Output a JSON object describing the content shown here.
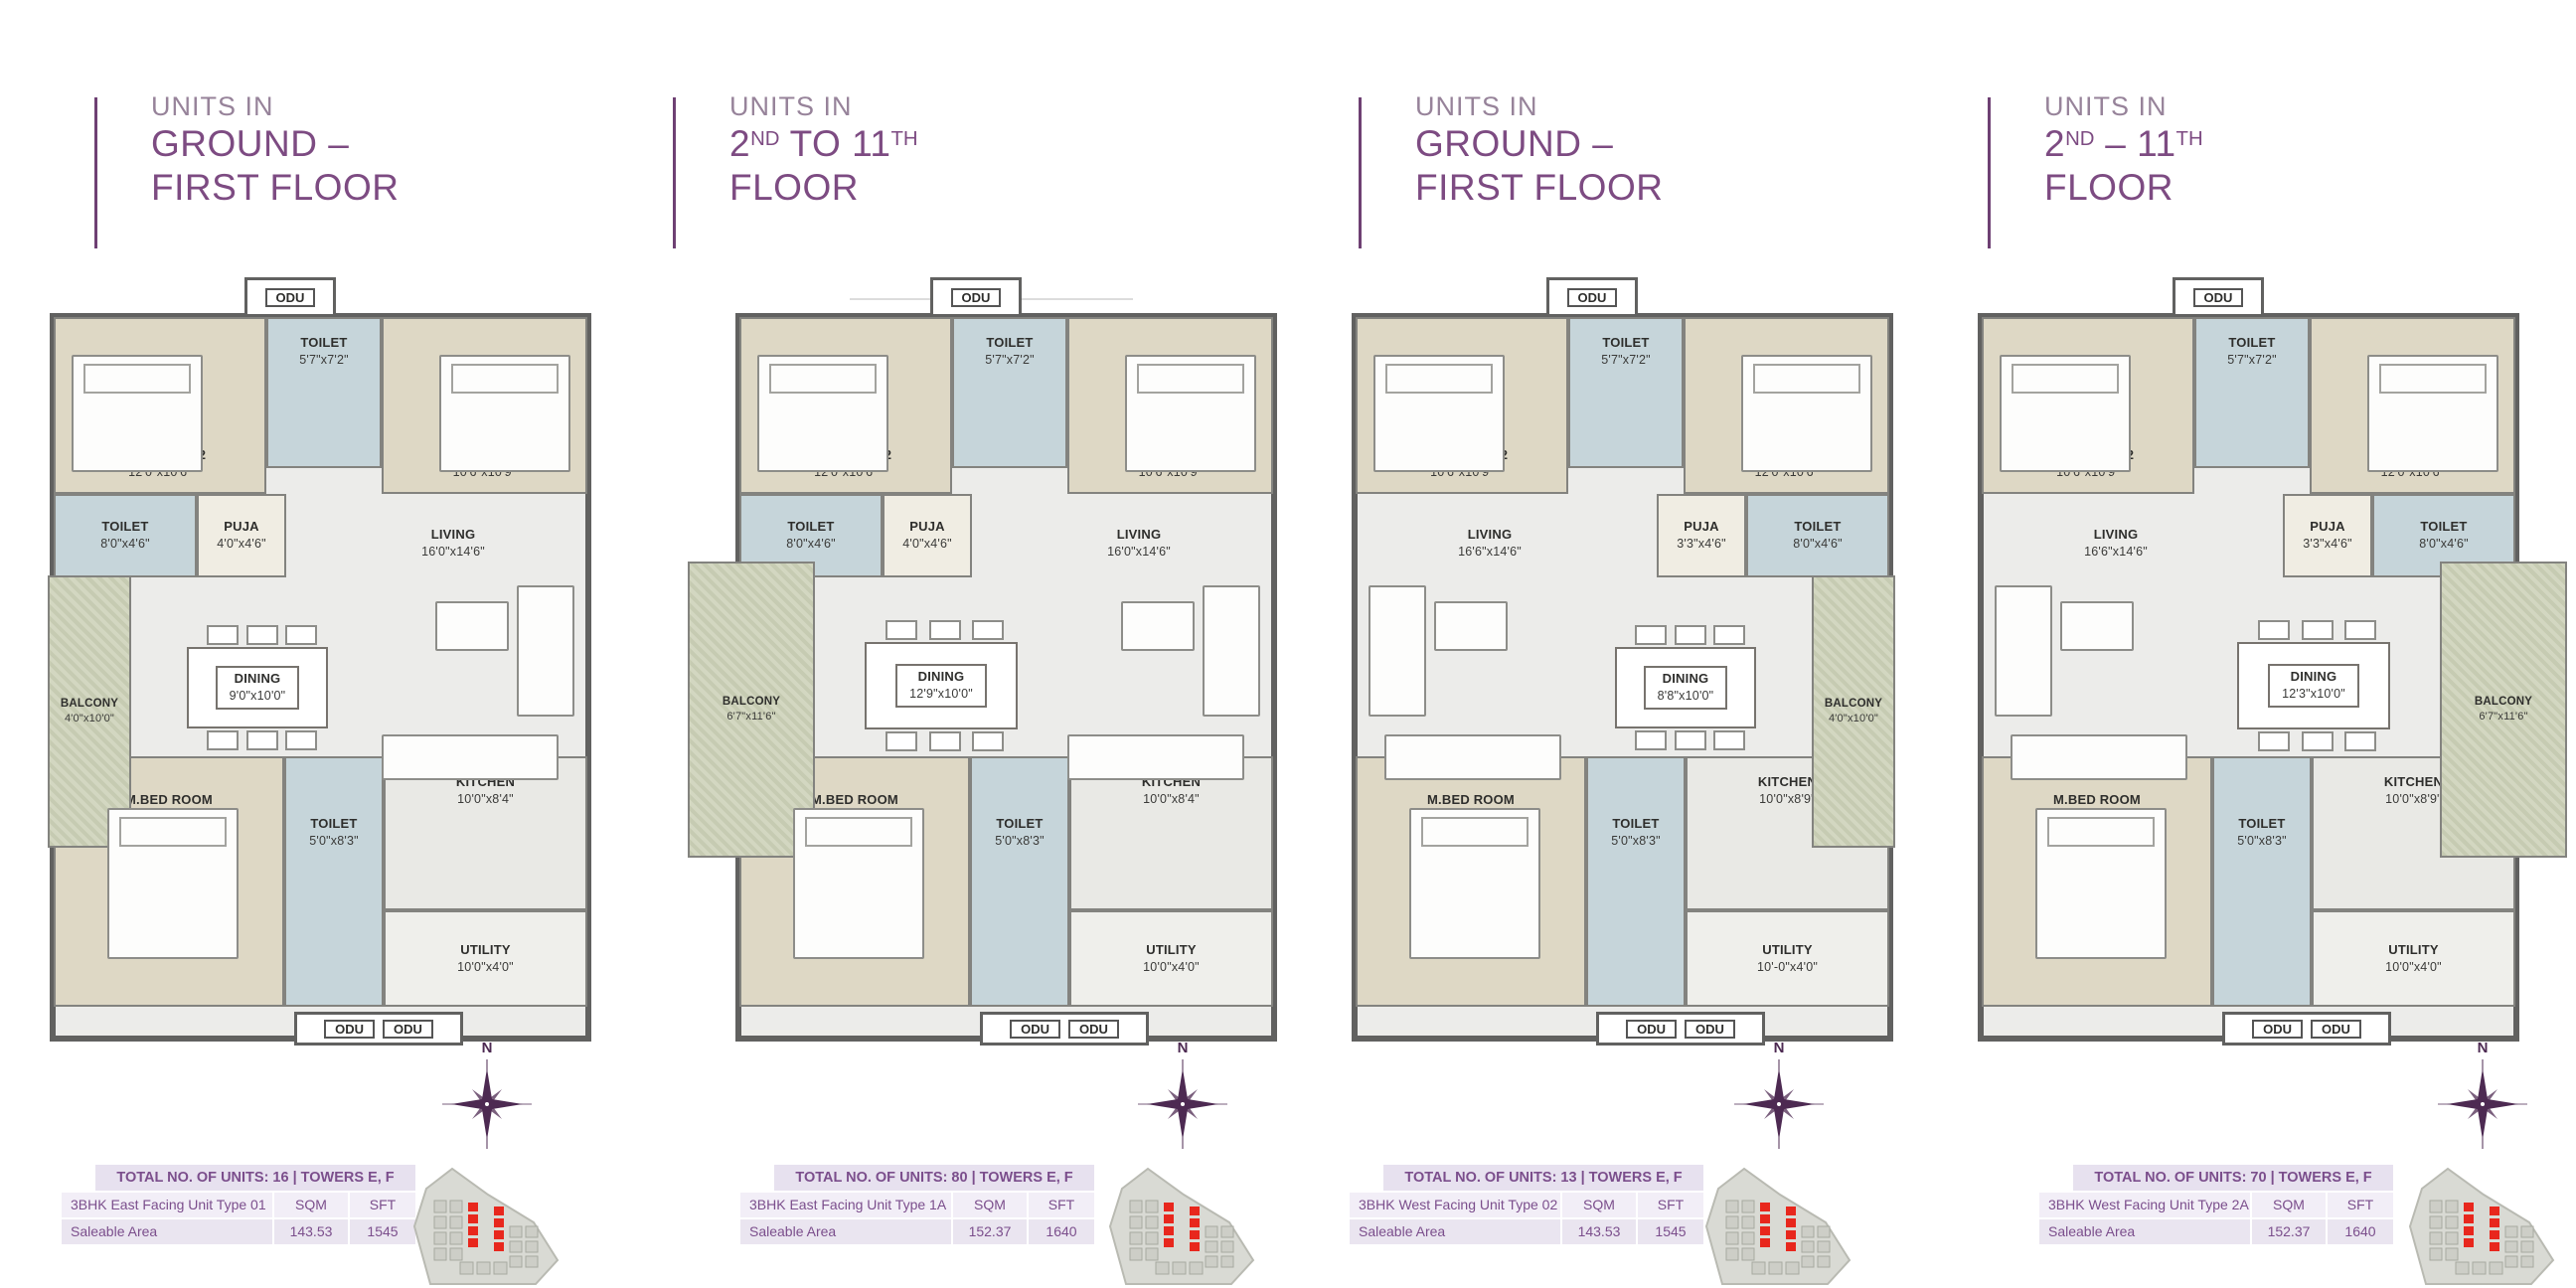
{
  "colors": {
    "brand_purple": "#7d4b82",
    "muted_purple": "#97839a",
    "accent_bar": "#6e4073",
    "table_text": "#7b4e8c",
    "table_header_bg": "#e7e1ef",
    "table_row_bg": "#f2eef7",
    "table_row_alt_bg": "#eae5f0",
    "highlight_red": "#e8271d",
    "compass": "#4d2a52"
  },
  "panels": [
    {
      "title": {
        "eyebrow": "UNITS IN",
        "lines": [
          [
            {
              "t": "GROUND –"
            }
          ],
          [
            {
              "t": "FIRST FLOOR"
            }
          ]
        ]
      },
      "variant": "east",
      "balcony_wide": false,
      "compass_label": "N",
      "rooms": {
        "odu_top": {
          "name": "ODU"
        },
        "bedroom_tl": {
          "name": "BED ROOM-02",
          "dims": "12'0\"x10'6\""
        },
        "toilet_top": {
          "name": "TOILET",
          "dims": "5'7\"x7'2\""
        },
        "bedroom_tr": {
          "name": "BED ROOM-03",
          "dims": "10'6\"x10'9\""
        },
        "toilet_mid": {
          "name": "TOILET",
          "dims": "8'0\"x4'6\""
        },
        "puja": {
          "name": "PUJA",
          "dims": "4'0\"x4'6\""
        },
        "living": {
          "name": "LIVING",
          "dims": "16'0\"x14'6\""
        },
        "balcony": {
          "name": "BALCONY",
          "dims": "4'0\"x10'0\""
        },
        "dining": {
          "name": "DINING",
          "dims": "9'0\"x10'0\""
        },
        "mbed": {
          "name": "M.BED ROOM",
          "dims": "13'0\"x12'0\""
        },
        "toilet_bot": {
          "name": "TOILET",
          "dims": "5'0\"x8'3\""
        },
        "kitchen": {
          "name": "KITCHEN",
          "dims": "10'0\"x8'4\""
        },
        "utility": {
          "name": "UTILITY",
          "dims": "10'0\"x4'0\""
        },
        "odu_bot": {
          "name": "ODU",
          "name2": "ODU"
        }
      },
      "table": {
        "header": "TOTAL NO. OF UNITS: 16 | TOWERS E, F",
        "unit_type": "3BHK East Facing Unit Type 01",
        "col_sqm": "SQM",
        "col_sft": "SFT",
        "area_label": "Saleable Area",
        "sqm": "143.53",
        "sft": "1545"
      }
    },
    {
      "title": {
        "eyebrow": "UNITS IN",
        "lines": [
          [
            {
              "t": "2"
            },
            {
              "t": "ND",
              "sup": true
            },
            {
              "t": " TO 11"
            },
            {
              "t": "TH",
              "sup": true
            }
          ],
          [
            {
              "t": "FLOOR"
            }
          ]
        ]
      },
      "variant": "east",
      "balcony_wide": true,
      "compass_label": "N",
      "rooms": {
        "odu_top": {
          "name": "ODU"
        },
        "bedroom_tl": {
          "name": "BED ROOM-02",
          "dims": "12'0\"x10'6\""
        },
        "toilet_top": {
          "name": "TOILET",
          "dims": "5'7\"x7'2\""
        },
        "bedroom_tr": {
          "name": "BED ROOM-03",
          "dims": "10'6\"x10'9\""
        },
        "toilet_mid": {
          "name": "TOILET",
          "dims": "8'0\"x4'6\""
        },
        "puja": {
          "name": "PUJA",
          "dims": "4'0\"x4'6\""
        },
        "living": {
          "name": "LIVING",
          "dims": "16'0\"x14'6\""
        },
        "balcony": {
          "name": "BALCONY",
          "dims": "6'7\"x11'6\""
        },
        "dining": {
          "name": "DINING",
          "dims": "12'9\"x10'0\""
        },
        "mbed": {
          "name": "M.BED ROOM",
          "dims": "13'0\"x12'0\""
        },
        "toilet_bot": {
          "name": "TOILET",
          "dims": "5'0\"x8'3\""
        },
        "kitchen": {
          "name": "KITCHEN",
          "dims": "10'0\"x8'4\""
        },
        "utility": {
          "name": "UTILITY",
          "dims": "10'0\"x4'0\""
        },
        "odu_bot": {
          "name": "ODU",
          "name2": "ODU"
        }
      },
      "table": {
        "header": "TOTAL NO. OF UNITS: 80 | TOWERS E, F",
        "unit_type": "3BHK East Facing Unit Type 1A",
        "col_sqm": "SQM",
        "col_sft": "SFT",
        "area_label": "Saleable Area",
        "sqm": "152.37",
        "sft": "1640"
      }
    },
    {
      "title": {
        "eyebrow": "UNITS IN",
        "lines": [
          [
            {
              "t": "GROUND –"
            }
          ],
          [
            {
              "t": "FIRST FLOOR"
            }
          ]
        ]
      },
      "variant": "west",
      "balcony_wide": false,
      "compass_label": "N",
      "rooms": {
        "odu_top": {
          "name": "ODU"
        },
        "bedroom_tl": {
          "name": "BED ROOM-02",
          "dims": "10'6\"x10'9\""
        },
        "toilet_top": {
          "name": "TOILET",
          "dims": "5'7\"x7'2\""
        },
        "bedroom_tr": {
          "name": "BED ROOM-03",
          "dims": "12'0\"x10'6\""
        },
        "puja": {
          "name": "PUJA",
          "dims": "3'3\"x4'6\""
        },
        "toilet_mid": {
          "name": "TOILET",
          "dims": "8'0\"x4'6\""
        },
        "living": {
          "name": "LIVING",
          "dims": "16'6\"x14'6\""
        },
        "balcony": {
          "name": "BALCONY",
          "dims": "4'0\"x10'0\""
        },
        "dining": {
          "name": "DINING",
          "dims": "8'8\"x10'0\""
        },
        "mbed": {
          "name": "M.BED ROOM",
          "dims": "13'0\"x12'0\""
        },
        "toilet_bot": {
          "name": "TOILET",
          "dims": "5'0\"x8'3\""
        },
        "kitchen": {
          "name": "KITCHEN",
          "dims": "10'0\"x8'9\""
        },
        "utility": {
          "name": "UTILITY",
          "dims": "10'-0\"x4'0\""
        },
        "odu_bot": {
          "name": "ODU",
          "name2": "ODU"
        }
      },
      "table": {
        "header": "TOTAL NO. OF UNITS: 13 | TOWERS E, F",
        "unit_type": "3BHK West Facing Unit Type 02",
        "col_sqm": "SQM",
        "col_sft": "SFT",
        "area_label": "Saleable Area",
        "sqm": "143.53",
        "sft": "1545"
      }
    },
    {
      "title": {
        "eyebrow": "UNITS IN",
        "lines": [
          [
            {
              "t": "2"
            },
            {
              "t": "ND",
              "sup": true
            },
            {
              "t": " – 11"
            },
            {
              "t": "TH",
              "sup": true
            }
          ],
          [
            {
              "t": "FLOOR"
            }
          ]
        ]
      },
      "variant": "west",
      "balcony_wide": true,
      "compass_label": "N",
      "rooms": {
        "odu_top": {
          "name": "ODU"
        },
        "bedroom_tl": {
          "name": "BED ROOM-02",
          "dims": "10'6\"x10'9\""
        },
        "toilet_top": {
          "name": "TOILET",
          "dims": "5'7\"x7'2\""
        },
        "bedroom_tr": {
          "name": "BED ROOM-03",
          "dims": "12'0\"x10'6\""
        },
        "puja": {
          "name": "PUJA",
          "dims": "3'3\"x4'6\""
        },
        "toilet_mid": {
          "name": "TOILET",
          "dims": "8'0\"x4'6\""
        },
        "living": {
          "name": "LIVING",
          "dims": "16'6\"x14'6\""
        },
        "balcony": {
          "name": "BALCONY",
          "dims": "6'7\"x11'6\""
        },
        "dining": {
          "name": "DINING",
          "dims": "12'3\"x10'0\""
        },
        "mbed": {
          "name": "M.BED ROOM",
          "dims": "13'0\"x12'0\""
        },
        "toilet_bot": {
          "name": "TOILET",
          "dims": "5'0\"x8'3\""
        },
        "kitchen": {
          "name": "KITCHEN",
          "dims": "10'0\"x8'9\""
        },
        "utility": {
          "name": "UTILITY",
          "dims": "10'0\"x4'0\""
        },
        "odu_bot": {
          "name": "ODU",
          "name2": "ODU"
        }
      },
      "table": {
        "header": "TOTAL NO. OF UNITS: 70 | TOWERS E, F",
        "unit_type": "3BHK West Facing Unit Type 2A",
        "col_sqm": "SQM",
        "col_sft": "SFT",
        "area_label": "Saleable Area",
        "sqm": "152.37",
        "sft": "1640"
      }
    }
  ]
}
